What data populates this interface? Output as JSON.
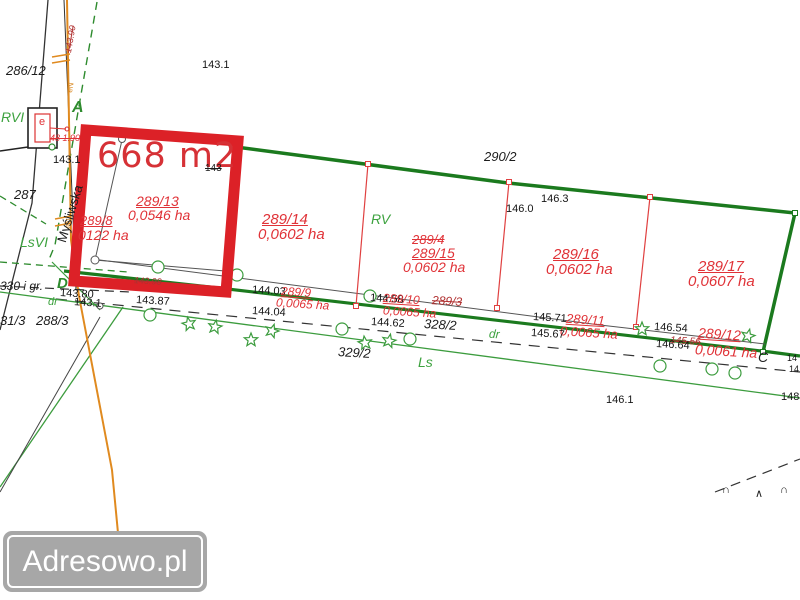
{
  "watermark": {
    "brand": "Adresowo.pl"
  },
  "highlight": {
    "area": "668 m2"
  },
  "street": {
    "name": "Myśliwska"
  },
  "parcels": {
    "p8": {
      "number": "289/8",
      "area": "0122 ha"
    },
    "p9": {
      "number": "289/9",
      "area": "0,0065 ha"
    },
    "p10": {
      "number": "289/10",
      "area": "0,0065 ha",
      "old_number": "289/3"
    },
    "p11": {
      "number": "289/11",
      "area": "0,0065 ha"
    },
    "p12": {
      "number": "289/12",
      "area": "0,0061 ha"
    },
    "p13": {
      "number": "289/13",
      "area": "0,0546 ha"
    },
    "p14": {
      "number": "289/14",
      "area": "0,0602 ha"
    },
    "p15": {
      "number": "289/15",
      "area": "0,0602 ha",
      "old_number": "289/4"
    },
    "p16": {
      "number": "289/16",
      "area": "0,0602 ha"
    },
    "p17": {
      "number": "289/17",
      "area": "0,0607 ha"
    }
  },
  "neighbor_parcels": {
    "n286_12": "286/12",
    "n287": "287",
    "n288_3": "288/3",
    "n31_3": "31/3",
    "n290_2": "290/2",
    "n328_2": "328/2",
    "n329_2": "329/2",
    "n330": "330 i gr."
  },
  "land_use": {
    "rvi": "RVI",
    "rv": "RV",
    "lsvi": "LsVI",
    "ls": "Ls",
    "dr_left": "dr",
    "dr_mid": "dr"
  },
  "section_points": {
    "a": "A",
    "c": "C",
    "d": "D"
  },
  "utility": {
    "e_station": "e",
    "pole_note_top": "143.90",
    "pole_note_mid": "48 1.90",
    "line_note_1": "eN",
    "line_note_2": "eN"
  },
  "elevations": {
    "e143_1_top": "143.1",
    "e143_1_road": "143.1",
    "e143_1_row": "143.1",
    "e143_80": "143.80",
    "e143_87": "143.87",
    "e144_03": "144.03",
    "e144_04": "144.04",
    "e144_58": "144.58",
    "e144_62": "144.62",
    "e145_71": "145.71",
    "e145_67": "145.67",
    "e146_0": "146.0",
    "e146_3": "146.3",
    "e146_54": "146.54",
    "e146_64": "146.64",
    "e146_1": "146.1",
    "e148": "148",
    "e14a": "14",
    "e14b": "14"
  },
  "struck_values": {
    "s143": "143",
    "s143_98": "143.98",
    "s145_56": "145.56"
  },
  "colors": {
    "highlight_red": "#dc2127",
    "label_red": "#e03237",
    "boundary_green": "#1b7a1e",
    "light_green": "#3c9c3e",
    "utility_orange": "#e08a1f",
    "struck_dark_red": "#b03030",
    "watermark_bg": "#a7a7a7"
  }
}
